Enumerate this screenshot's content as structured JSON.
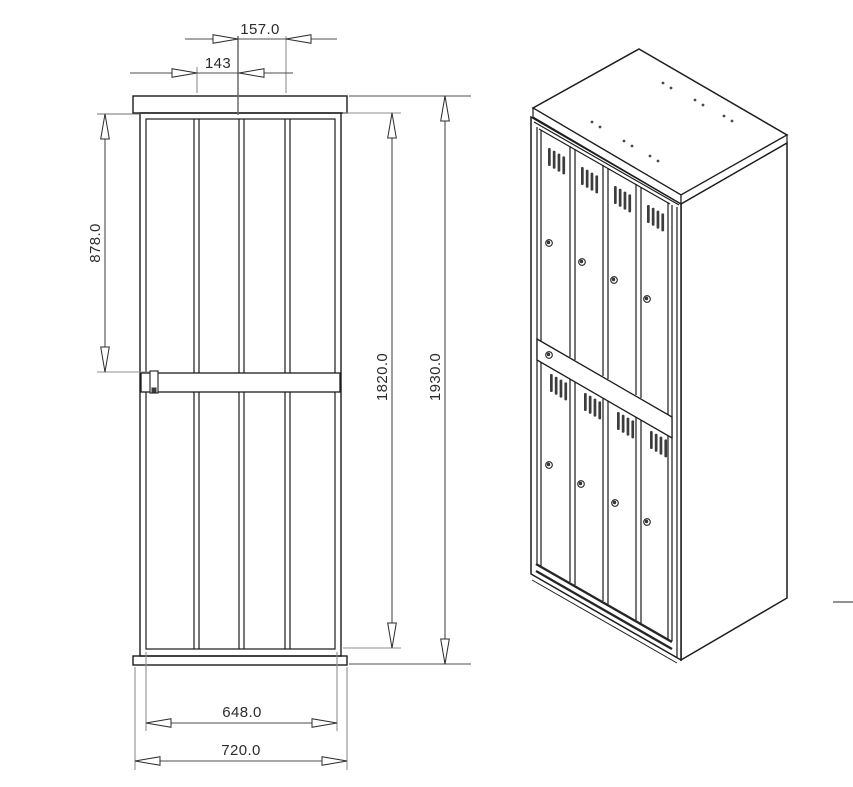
{
  "page": {
    "background": "#ffffff"
  },
  "drawing": {
    "dimensions": {
      "top_outer": "157.0",
      "top_inner": "143",
      "left_vertical": "878.0",
      "right_inner": "1820.0",
      "right_outer": "1930.0",
      "bottom_inner": "648.0",
      "bottom_outer": "720.0"
    },
    "subject": {
      "door_columns": 4,
      "door_rows": 2,
      "doors_total": 8
    },
    "colors": {
      "part_line": "#1c1c1c",
      "dimension_line": "#4d4d4d",
      "extension_line": "#8f8f8f",
      "text": "#2b2b2b",
      "vent_fill": "#3c3c3c",
      "background": "#ffffff"
    }
  }
}
